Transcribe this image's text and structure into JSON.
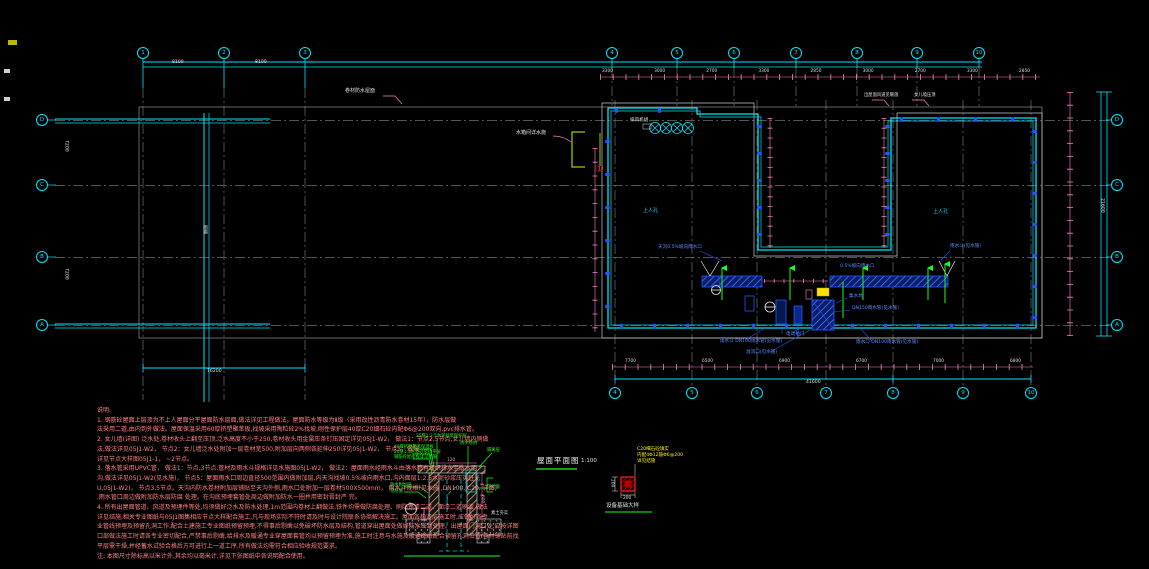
{
  "titles": {
    "plan": "屋面平面图",
    "scale": "1:100"
  },
  "grid": {
    "top": [
      "1",
      "2",
      "3",
      "4",
      "5",
      "6",
      "7",
      "8",
      "9",
      "10"
    ],
    "bottom": [
      "4",
      "5",
      "6",
      "7",
      "8",
      "9",
      "10"
    ],
    "left": [
      "D",
      "C",
      "B",
      "A"
    ],
    "right": [
      "D",
      "C",
      "B",
      "A"
    ]
  },
  "labels": {
    "roof_membrane": "卷材防水屋面",
    "water_tank": "水箱间详水施",
    "exhaust_fan": "排风机组",
    "roof_access_1": "上人孔",
    "roof_access_2": "上人孔",
    "canopy": "雨棚",
    "gutter_left": "天沟0.5%坡向雨水口",
    "rain_hopper_right": "雨水斗(见水施)",
    "slope_to_drain": "0.5%坡向雨水口",
    "sump_pit": "集水坑",
    "rain_pipe_150": "DN150雨水管(见水施)",
    "flap_gate": "电动拍门",
    "hopper_bottom_left": "雨水斗 DN100雨水管(见水施)",
    "hopper_bottom_right": "雨水口 DN100雨水管(见水施)",
    "overflow": "溢流口(见水施)",
    "parapet_coping": "女儿墙压顶",
    "roof_vent": "出屋面风道见暖施",
    "section_mark": "①"
  },
  "dims": {
    "top": [
      "3300",
      "3000",
      "2700",
      "3300",
      "2850",
      "3000",
      "2700",
      "3300",
      "2850"
    ],
    "bottom": [
      "7700",
      "6500",
      "6900",
      "6700",
      "7000",
      "6800"
    ],
    "bottom_total": "41600",
    "left_total": "16200",
    "right_total": "21600",
    "canopy_a": "7200",
    "canopy_b": "7200",
    "tl_a": "8100",
    "tl_b": "8100"
  },
  "detail1": {
    "top_label_1": "25厚1:2.5水泥砂浆保护层",
    "top_label_2": "防水卷材",
    "top_label_3": "隔离层",
    "left_label_1": "40厚挤塑聚苯保温板",
    "left_label_2": "20厚1:3水泥砂浆找平层",
    "left_label_3": "钢筋砼屋面板详见结施",
    "left_label_4": "防水附加层",
    "left_label_5": "见结施",
    "right_label_1": "见结施",
    "right_label_2": "素土夯实",
    "mark": "1",
    "dim_v": "600",
    "dim_h": "120"
  },
  "detail2": {
    "note_1": "C20细石砼填实",
    "note_2": "内配4Φ12箍Φ6@200",
    "note_3": "详见结施",
    "dim_w": "200",
    "dim_h": "200",
    "title": "设备基础大样"
  },
  "notes": {
    "heading": "说明:",
    "lines": [
      "1. 钢筋砼屋面上层顶为不上人屋面分平屋面防水层面,做法详见工程做法。屋面防水等级为Ⅱ级（采用改性沥青防水卷材15年），防水层做",
      "法采用二道,由内到外做法。屋面保温采用60厚挤塑聚苯板,找坡采用陶粒砼2%找坡,刚性保护层40厚C20细石砼内配Φ6@200双向,pvc排水管。",
      "2. 女儿墙(详图)  泛水处,卷材收头上翻至压顶,泛水高度不小于250,卷材收头用金属压条钉压固定详见05J1-W2，  做法1：节点2,5节点,女儿墙内侧做",
      "法,做法详见05J1-W2，  节点2：女儿墙泛水处附加一层卷材宽500,附加层向两侧各延伸250详见05J1-W2，  节点3：做法",
      "详见节点大样图05J1-1，  ~2节点。",
      "3. 落水管采用UPVC管，  做法1：节点,3节点,管材及雨水斗规格详见水施图05J1-W2，  做法2：屋面雨水经雨水斗由落水管有组织排水至散水明",
      "沟,做法详见05J1-W2(见水施)，  节点5：屋面雨水口周边直径500范围内做附加层,内天沟找坡0.5%坡向雨水口,沟内面层1:2.5水泥砂浆压实赶光",
      "U,05J1-W2)，  节点3,5节点。天沟内防水卷材附加层铺贴至天沟外侧,雨水口处附加一层卷材500X500mm，  雨水斗规格(见水施 ,DN100, C20, 详图)",
      ",雨水管口周边做附加防水层防腐  处理。在沟底预埋套管处周边做附加防水一圈并用密封膏封严  完。",
      "4. 所有出屋面管道、风道及预埋件等处,均须做好泛水及防水处理,1m范围内卷材上翻做法,铁件均需做防腐处理、刷防锈漆二道、面漆二道刷漆,做法",
      "详见结施,相关专业图纸与05J1图集相应节点大样配合施工,凡与现场实际不符时请及时与设计院联系协商解决施工。屋面各构造层施工时,应做好各专",
      "业管线预埋及预留孔洞工作,配合土建施工专业图纸预留预埋,不得事后剔凿以免破坏防水层及结构,管道穿出屋面处做好防水密封处理。出屋面门洞口处,应按详图",
      "口部做法施工时请各专业密切配合,严禁事后剔凿,给排水及暖通专业穿屋面套管均以预留预埋为准,施工时注意与水施及暖通图纸配合预留孔洞位置,卷材铺贴前找",
      "平层需干燥,并经蓄水试验合格后方可进行上一道工序,所有做法均需符合相应验收规范要求。",
      "注: 本图尺寸除标高以米计外,其余均以毫米计,详见下张图纸中各说明配合使用。"
    ]
  }
}
